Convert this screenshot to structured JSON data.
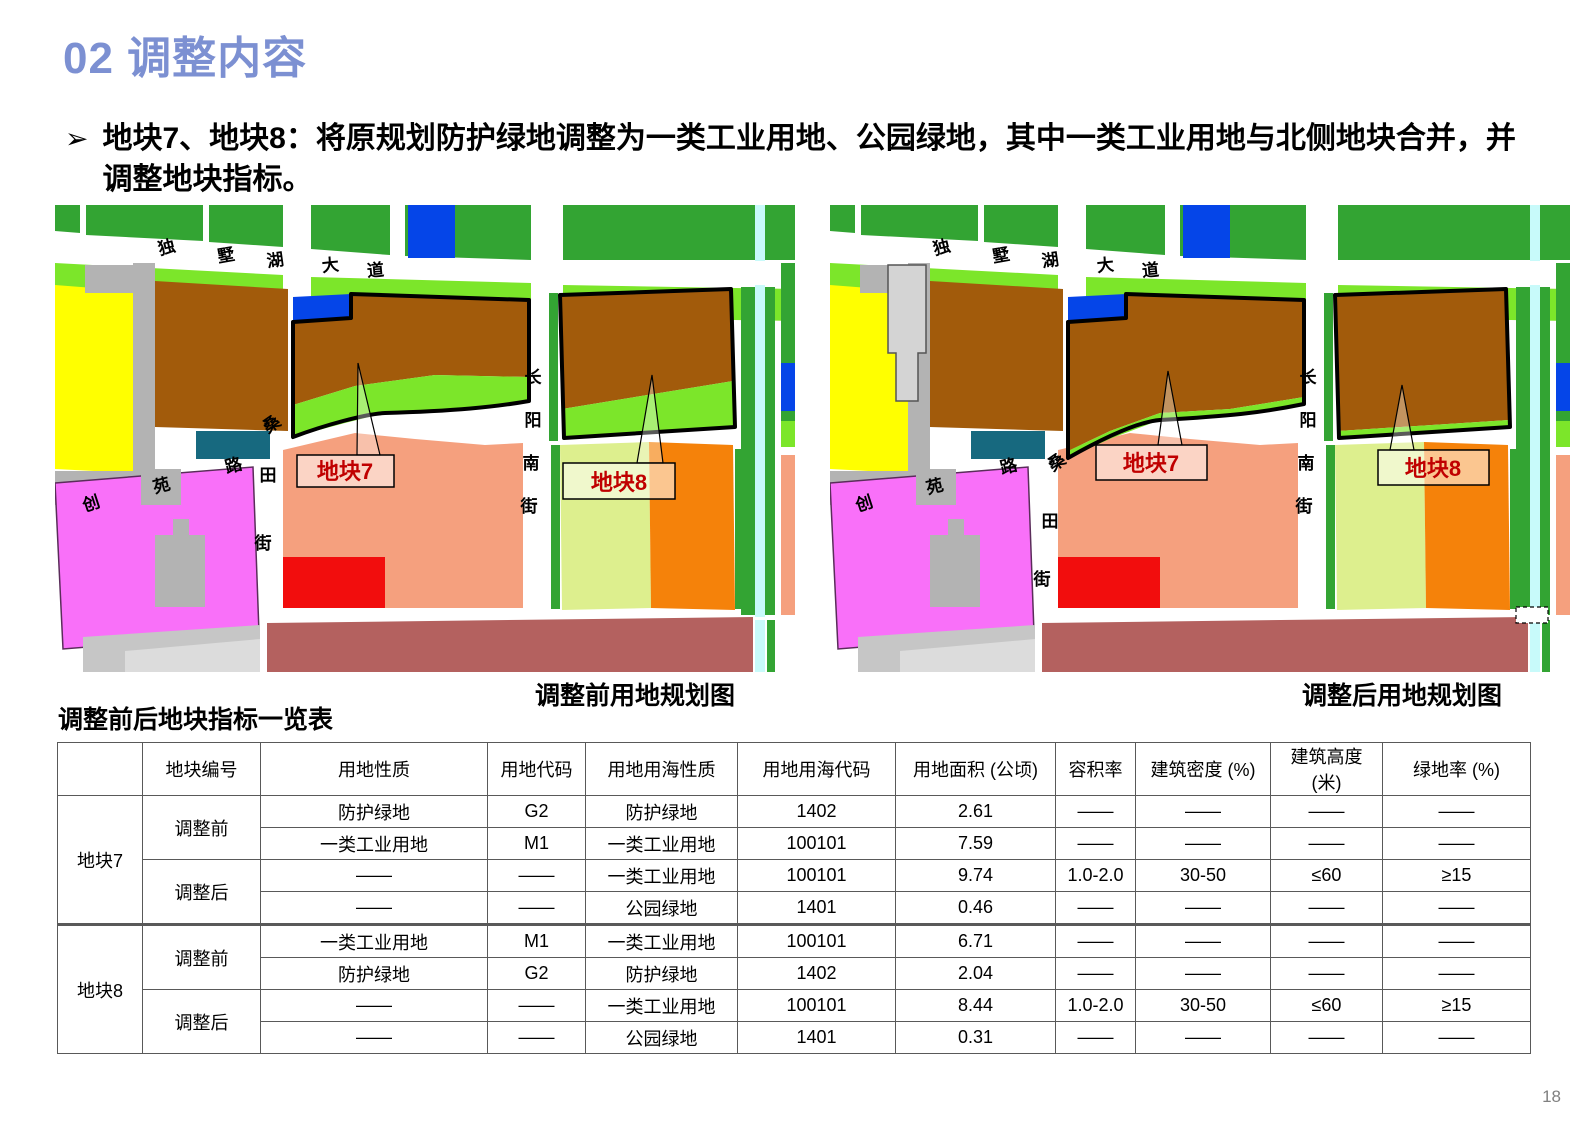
{
  "header": {
    "title": "02 调整内容"
  },
  "intro": {
    "bullet": "➢",
    "text": "地块7、地块8：将原规划防护绿地调整为一类工业用地、公园绿地，其中一类工业用地与北侧地块合并，并调整地块指标。"
  },
  "maps": {
    "before_title": "调整前用地规划图",
    "after_title": "调整后用地规划图",
    "labels": {
      "dushuhu_road": [
        "独",
        "墅",
        "湖",
        "大",
        "道"
      ],
      "sangtian_road": [
        "桑",
        "田",
        "街"
      ],
      "chuangyuan_road": [
        "创",
        "苑",
        "路"
      ],
      "changyang_road": [
        "长",
        "阳",
        "南",
        "街"
      ],
      "plot7_callout": "地块7",
      "plot8_callout": "地块8"
    }
  },
  "colors": {
    "title_blue": "#7C90D2",
    "callout_red": "#C00000",
    "park_green": "#33A433",
    "protective_green": "#7CE62A",
    "industrial_brown": "#A25B0B",
    "water_blue": "#0545E8",
    "canal_cyan": "#C8FAFA",
    "residential_yellow": "#FFFF00",
    "magenta_pink": "#F970F9",
    "salmon": "#F5A07E",
    "red": "#F20D0D",
    "orange": "#F5820A",
    "pale_green": "#DDEF8E",
    "teal": "#17697F",
    "maroon": "#B4615F"
  },
  "table": {
    "title": "调整前后地块指标一览表",
    "headers": [
      "",
      "地块编号",
      "用地性质",
      "用地代码",
      "用地用海性质",
      "用地用海代码",
      "用地面积 (公顷)",
      "容积率",
      "建筑密度 (%)",
      "建筑高度 (米)",
      "绿地率 (%)"
    ],
    "groups": [
      {
        "plot": "地块7",
        "phases": [
          "调整前",
          "调整后"
        ]
      },
      {
        "plot": "地块8",
        "phases": [
          "调整前",
          "调整后"
        ]
      }
    ],
    "rows": [
      [
        "防护绿地",
        "G2",
        "防护绿地",
        "1402",
        "2.61",
        "——",
        "——",
        "——",
        "——"
      ],
      [
        "一类工业用地",
        "M1",
        "一类工业用地",
        "100101",
        "7.59",
        "——",
        "——",
        "——",
        "——"
      ],
      [
        "——",
        "——",
        "一类工业用地",
        "100101",
        "9.74",
        "1.0-2.0",
        "30-50",
        "≤60",
        "≥15"
      ],
      [
        "——",
        "——",
        "公园绿地",
        "1401",
        "0.46",
        "——",
        "——",
        "——",
        "——"
      ],
      [
        "一类工业用地",
        "M1",
        "一类工业用地",
        "100101",
        "6.71",
        "——",
        "——",
        "——",
        "——"
      ],
      [
        "防护绿地",
        "G2",
        "防护绿地",
        "1402",
        "2.04",
        "——",
        "——",
        "——",
        "——"
      ],
      [
        "——",
        "——",
        "一类工业用地",
        "100101",
        "8.44",
        "1.0-2.0",
        "30-50",
        "≤60",
        "≥15"
      ],
      [
        "——",
        "——",
        "公园绿地",
        "1401",
        "0.31",
        "——",
        "——",
        "——",
        "——"
      ]
    ]
  },
  "page_number": "18"
}
